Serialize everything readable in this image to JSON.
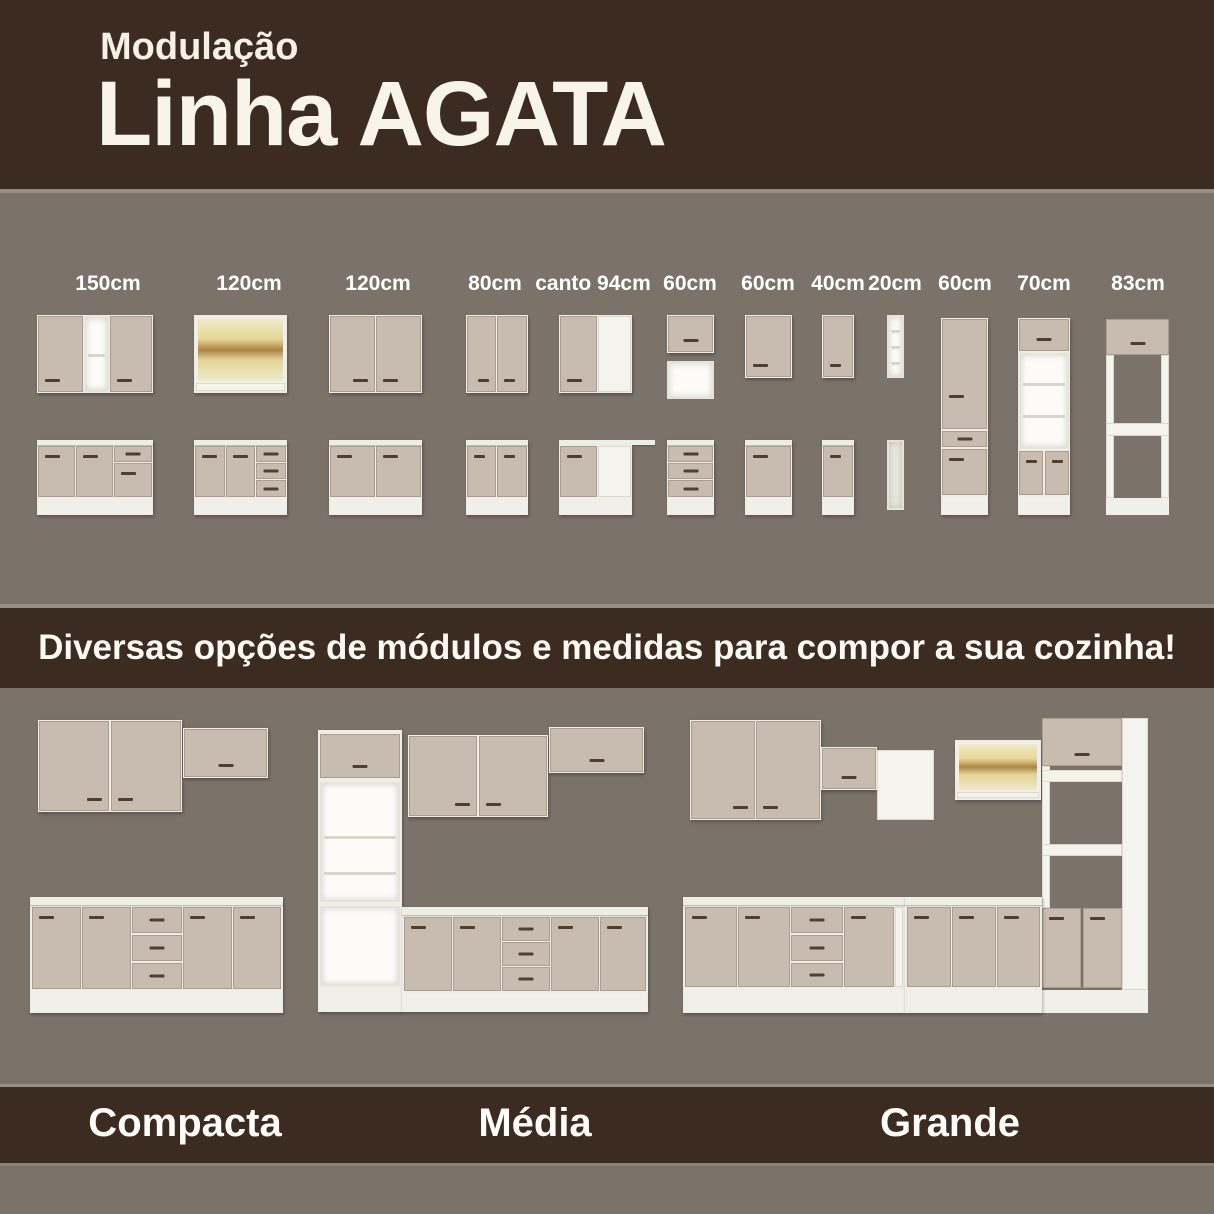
{
  "header": {
    "kicker": "Modulação",
    "title": "Linha AGATA"
  },
  "tagline": "Diversas opções de módulos e medidas para compor a sua cozinha!",
  "modules": [
    {
      "label": "150cm"
    },
    {
      "label": "120cm"
    },
    {
      "label": "120cm"
    },
    {
      "label": "80cm"
    },
    {
      "label": "canto 94cm"
    },
    {
      "label": "60cm"
    },
    {
      "label": "60cm"
    },
    {
      "label": "40cm"
    },
    {
      "label": "20cm"
    },
    {
      "label": "60cm"
    },
    {
      "label": "70cm"
    },
    {
      "label": "83cm"
    }
  ],
  "kitchens": [
    {
      "name": "Compacta"
    },
    {
      "name": "Média"
    },
    {
      "name": "Grande"
    }
  ],
  "colors": {
    "background_gray": "#7b726a",
    "band_brown": "#3b2b20",
    "cream_text": "#f6f1e6",
    "door_beige": "#c8bcb0",
    "carcass_white": "#f1efe9",
    "handle_brown": "#503f30",
    "glass_wood": "#ad8448"
  }
}
